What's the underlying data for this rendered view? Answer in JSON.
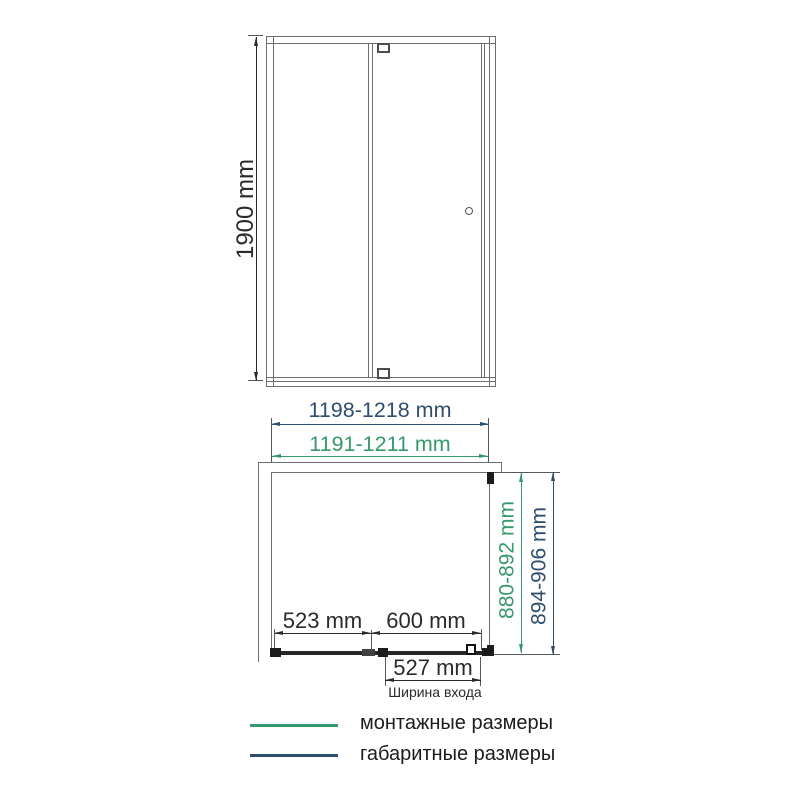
{
  "front_view": {
    "height_dim": "1900 mm"
  },
  "width_dims": {
    "overall": "1198-1218 mm",
    "mounting": "1191-1211 mm"
  },
  "depth_dims": {
    "mounting": "880-892 mm",
    "overall": "894-906 mm"
  },
  "plan_view": {
    "fixed_segment": "523 mm",
    "door_segment": "600 mm",
    "entry_width": "527 mm",
    "entry_caption": "Ширина входа"
  },
  "legend": {
    "mounting": {
      "label": "монтажные размеры",
      "color": "#35996b"
    },
    "overall": {
      "label": "габаритные размеры",
      "color": "#2f4d6d"
    }
  }
}
